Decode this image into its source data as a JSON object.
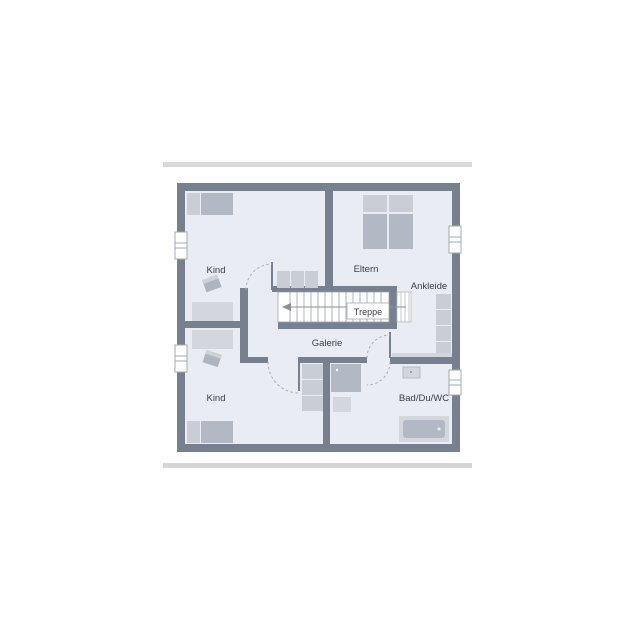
{
  "image": {
    "type": "floor-plan",
    "floor": "upper-floor",
    "orientation": "stairs-centered"
  },
  "colors": {
    "background": "#ffffff",
    "separator_bar_top": "#d9d9d9",
    "separator_bar_bottom": "#d6d6d6",
    "wall": "#76808e",
    "floor": "#e9ecf2",
    "furniture_dark": "#b2b8c4",
    "furniture_mid": "#c9ced6",
    "furniture_light": "#d3d6dc",
    "stair_line": "#9aa2ad",
    "door_arc": "#a8adb5",
    "text": "#3b4046"
  },
  "labels": {
    "kind_top": "Kind",
    "eltern": "Eltern",
    "ankleide": "Ankleide",
    "treppe": "Treppe",
    "galerie": "Galerie",
    "kind_bottom": "Kind",
    "bad": "Bad/Du/WC"
  },
  "rooms": [
    {
      "label": "Kind",
      "position": "top-left"
    },
    {
      "label": "Eltern",
      "position": "top-right"
    },
    {
      "label": "Ankleide",
      "position": "right"
    },
    {
      "label": "Treppe",
      "position": "center-stairs"
    },
    {
      "label": "Galerie",
      "position": "center"
    },
    {
      "label": "Kind",
      "position": "bottom-left"
    },
    {
      "label": "Bad/Du/WC",
      "position": "bottom-right"
    }
  ],
  "stairs": {
    "label": "Treppe",
    "walk_line_arrow_direction": "left",
    "tread_count_main": 15,
    "tread_count_upper": 4
  },
  "symbols": [
    "single-bed",
    "single-bed",
    "double-bed",
    "desk",
    "desk",
    "chair",
    "chair",
    "sideboard",
    "wardrobe",
    "closet",
    "shower",
    "shelf",
    "washbasin",
    "bathtub",
    "window",
    "window",
    "window",
    "window",
    "door-swing",
    "door-swing",
    "door-swing",
    "door-swing"
  ]
}
